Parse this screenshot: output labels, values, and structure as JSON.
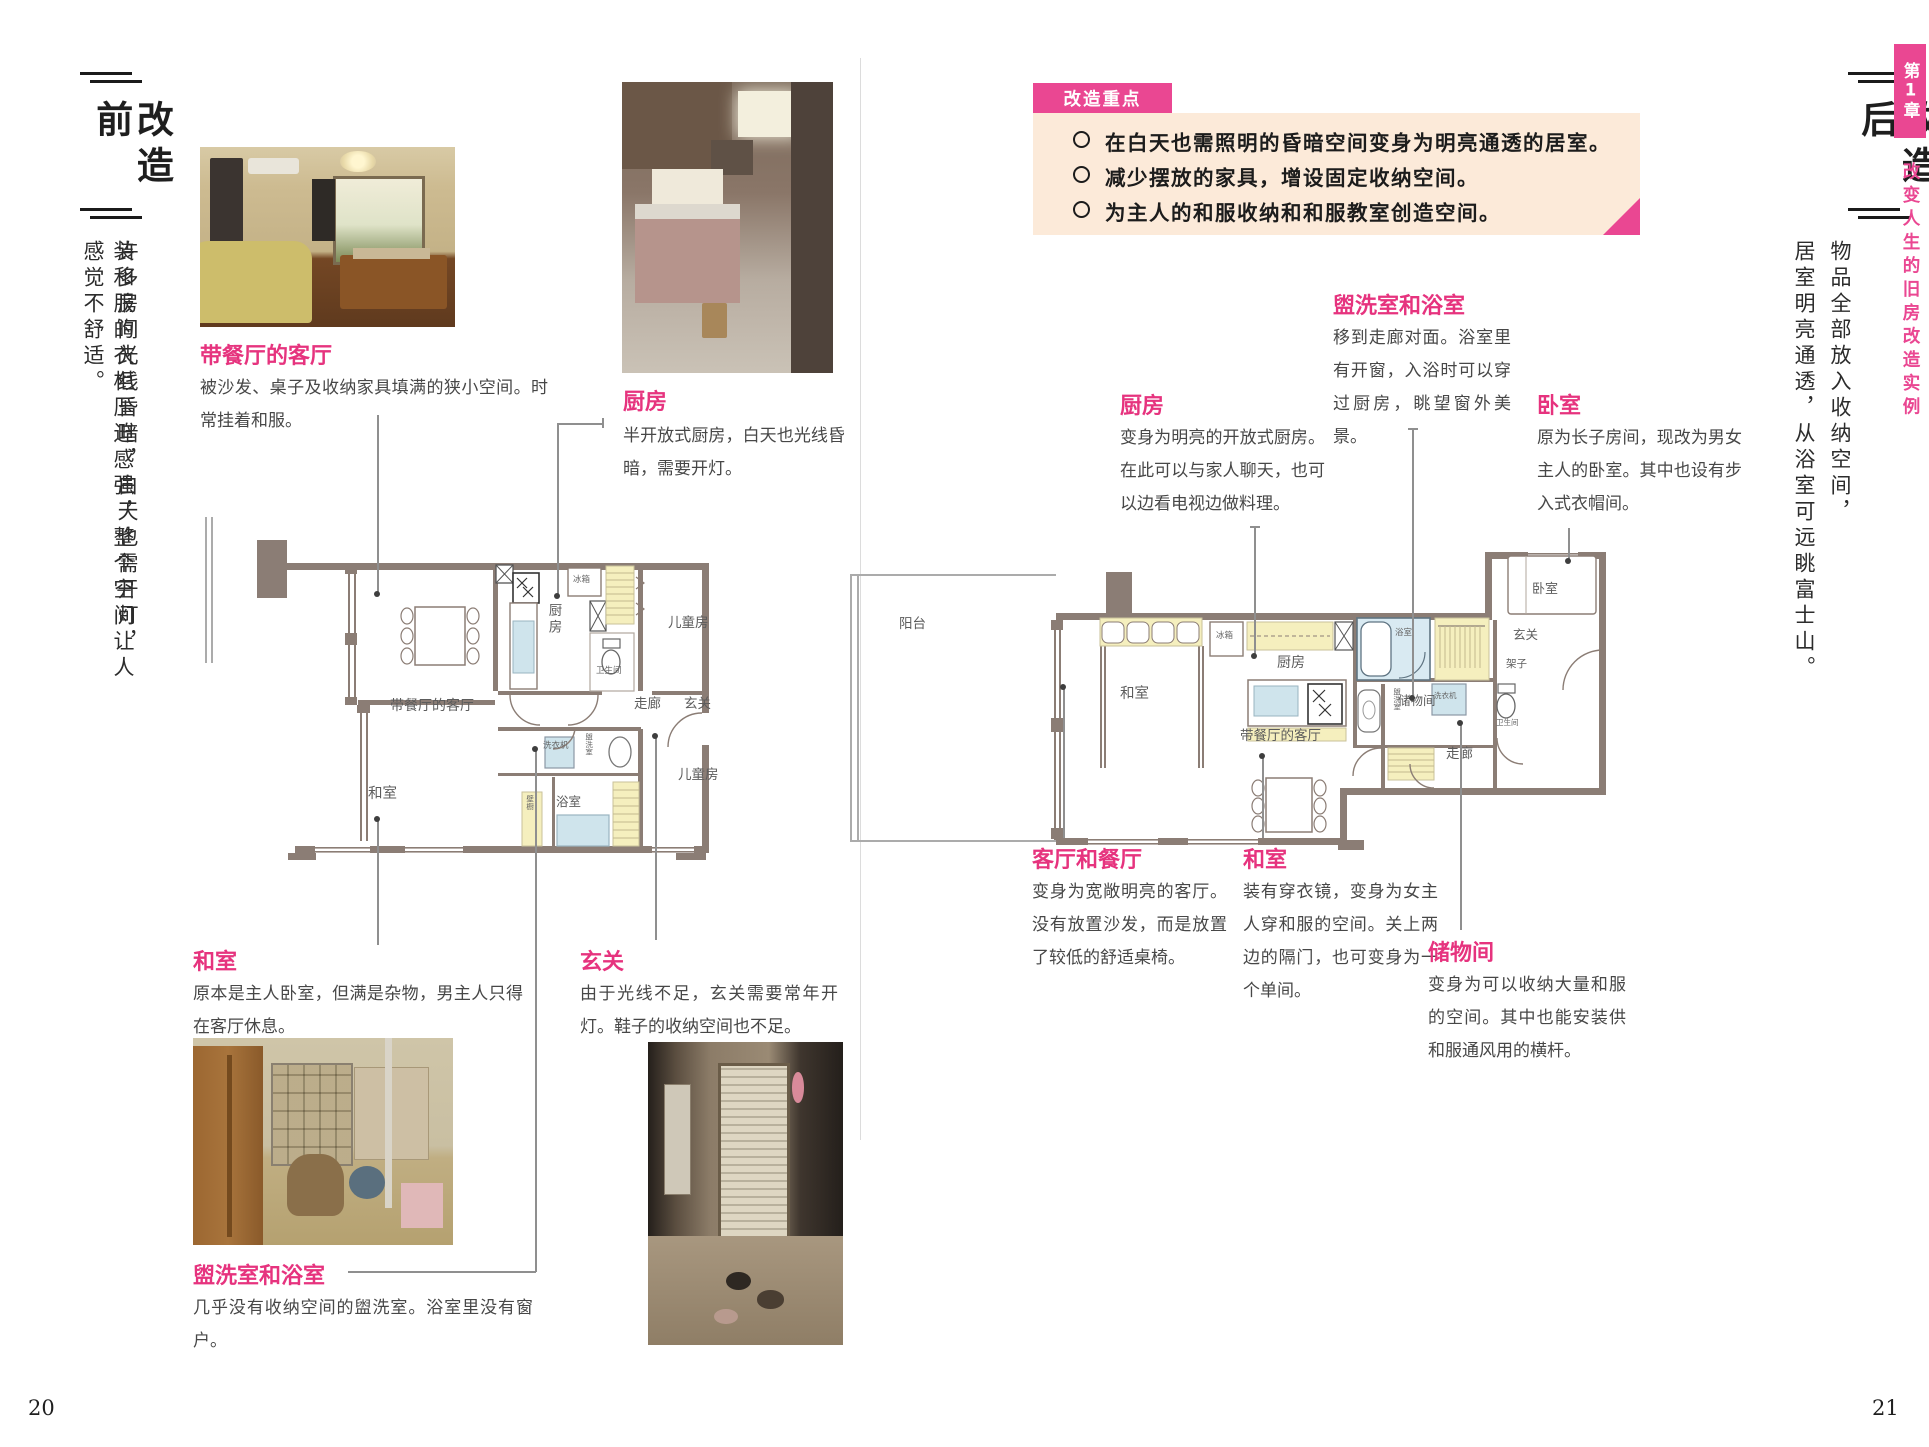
{
  "left_page": {
    "header_title": "改造前",
    "intro_col1": "许多房间光线昏暗，白天也需开灯，",
    "intro_col2": "装和服的衣柜压迫感强，整个空间让人感觉不舒适。",
    "page_number": "20",
    "sections": {
      "living": {
        "title": "带餐厅的客厅",
        "desc": "被沙发、桌子及收纳家具填满的狭小空间。时常挂着和服。"
      },
      "kitchen": {
        "title": "厨房",
        "desc": "半开放式厨房，白天也光线昏暗，需要开灯。"
      },
      "washitsu": {
        "title": "和室",
        "desc": "原本是主人卧室，但满是杂物，男主人只得在客厅休息。"
      },
      "entrance": {
        "title": "玄关",
        "desc": "由于光线不足，玄关需要常年开灯。鞋子的收纳空间也不足。"
      },
      "washroom": {
        "title": "盥洗室和浴室",
        "desc": "几乎没有收纳空间的盥洗室。浴室里没有窗户。"
      }
    },
    "plan": {
      "living": "带餐厅的客厅",
      "kitchen": "厨房",
      "fridge": "冰箱",
      "kids_top": "儿童房",
      "toilet": "卫生间",
      "corridor": "走廊",
      "entrance": "玄关",
      "washer": "洗衣机",
      "washroom": "盥洗室",
      "washitsu": "和室",
      "bath": "浴室",
      "closet": "壁橱",
      "kids_bottom": "儿童房"
    }
  },
  "right_page": {
    "header_title": "改造后",
    "intro_col1": "物品全部放入收纳空间，",
    "intro_col2": "居室明亮通透，从浴室可远眺富士山。",
    "page_number": "21",
    "highlights": {
      "tab": "改造重点",
      "items": [
        "在白天也需照明的昏暗空间变身为明亮通透的居室。",
        "减少摆放的家具，增设固定收纳空间。",
        "为主人的和服收纳和和服教室创造空间。"
      ]
    },
    "sections": {
      "washroom": {
        "title": "盥洗室和浴室",
        "desc": "移到走廊对面。浴室里有开窗，入浴时可以穿过厨房，眺望窗外美景。"
      },
      "kitchen": {
        "title": "厨房",
        "desc": "变身为明亮的开放式厨房。在此可以与家人聊天，也可以边看电视边做料理。"
      },
      "bedroom": {
        "title": "卧室",
        "desc": "原为长子房间，现改为男女主人的卧室。其中也设有步入式衣帽间。"
      },
      "living": {
        "title": "客厅和餐厅",
        "desc": "变身为宽敞明亮的客厅。没有放置沙发，而是放置了较低的舒适桌椅。"
      },
      "washitsu": {
        "title": "和室",
        "desc": "装有穿衣镜，变身为女主人穿和服的空间。关上两边的隔门，也可变身为一个单间。"
      },
      "storage": {
        "title": "储物间",
        "desc": "变身为可以收纳大量和服的空间。其中也能安装供和服通风用的横杆。"
      }
    },
    "plan": {
      "balcony": "阳台",
      "fridge": "冰箱",
      "kitchen": "厨房",
      "living": "带餐厅的客厅",
      "bath": "浴室",
      "washroom": "盥洗室",
      "washer": "洗衣机",
      "toilet": "卫生间",
      "corridor": "走廊",
      "bedroom": "卧室",
      "entrance": "玄关",
      "shelf": "架子",
      "storage": "储物间",
      "washitsu": "和室"
    },
    "chapter": {
      "tab": "第1章",
      "title": "改变人生的旧房改造实例"
    }
  },
  "colors": {
    "accent_pink": "#e6337e",
    "tab_pink": "#ea4792",
    "peach_box": "#fcead9",
    "plan_wall": "#8b7d75",
    "plan_yellow": "#f5efbe",
    "plan_blue": "#cfe4ec"
  }
}
